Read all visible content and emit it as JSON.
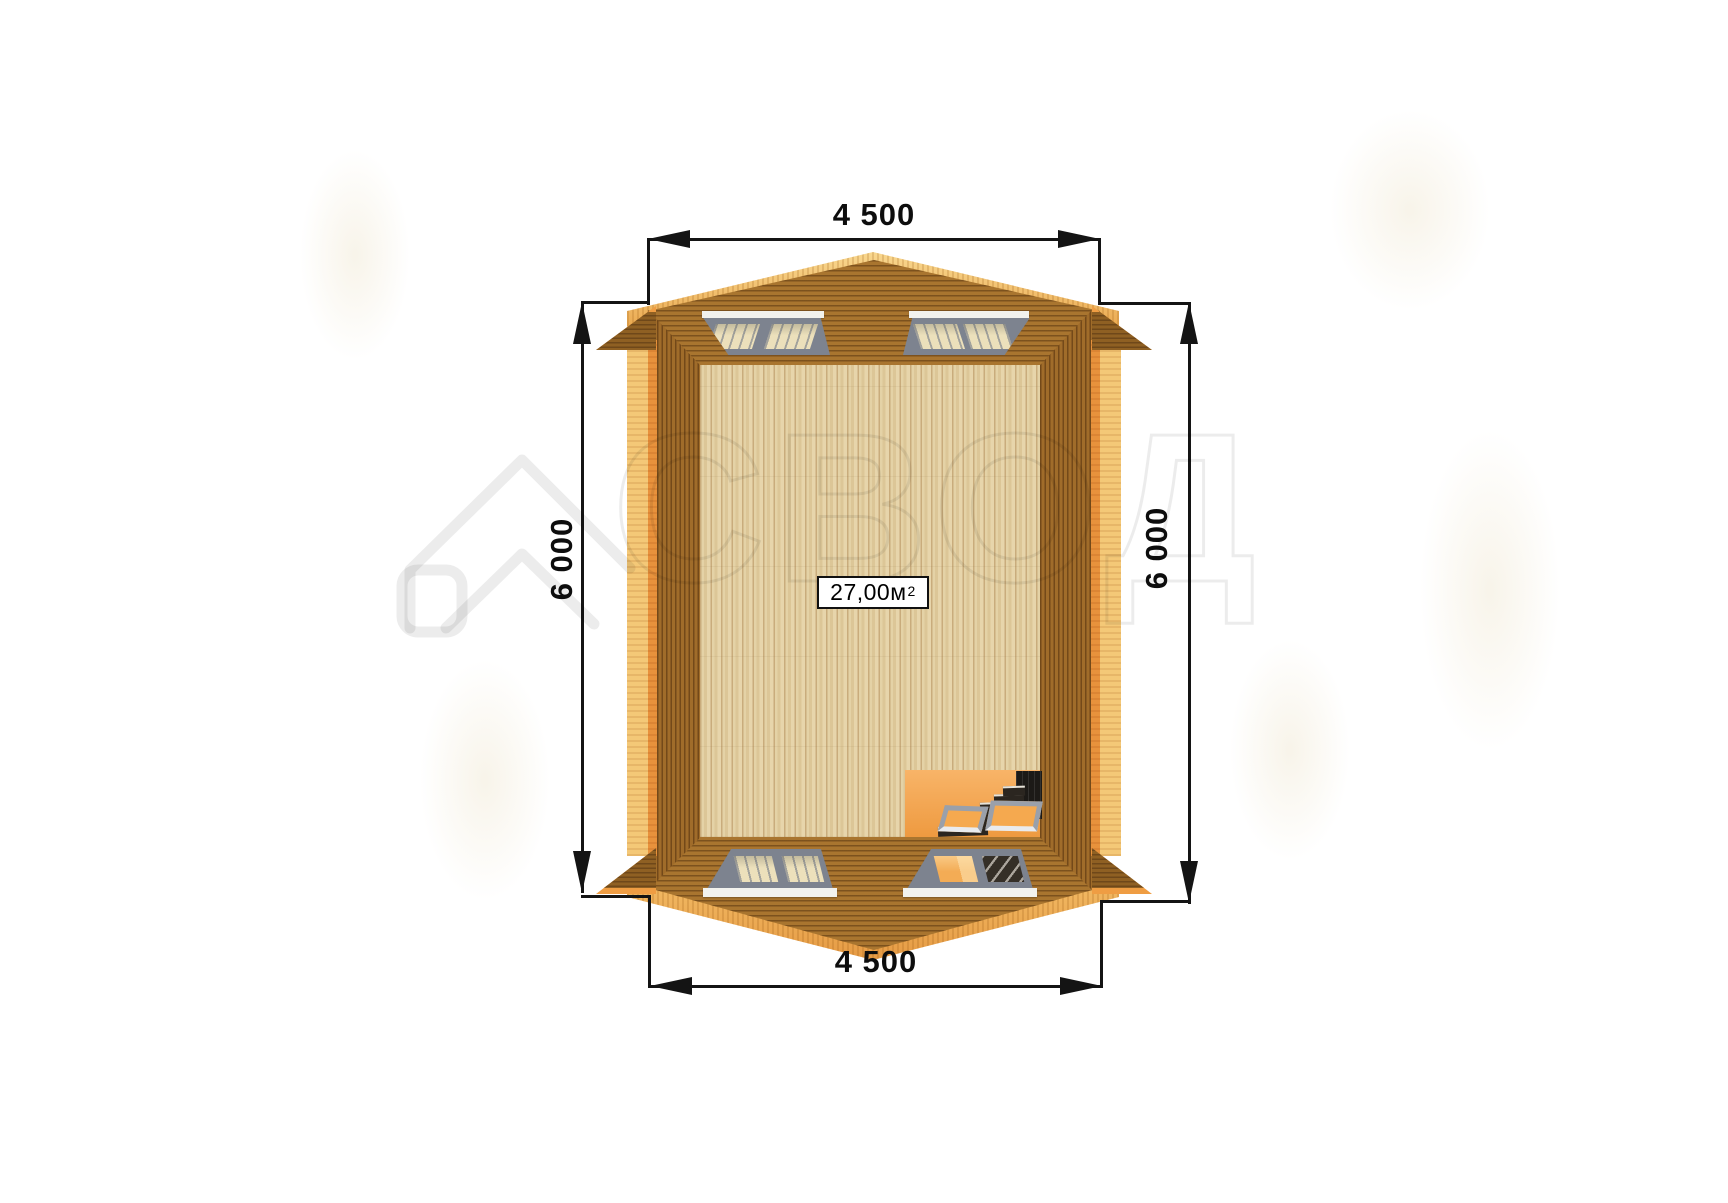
{
  "watermark": {
    "brand_text": "СВОД",
    "logo": "house-roof-outline"
  },
  "dimensions": {
    "top_width": "4 500",
    "bottom_width": "4 500",
    "left_height": "6 000",
    "right_height": "6 000"
  },
  "plan": {
    "area_value": "27,00м",
    "area_superscript": "2",
    "features": {
      "skylight_windows": 4,
      "staircase": "bottom-right opening with steps to lower floor"
    }
  },
  "colors": {
    "roof_brown": "#a9752f",
    "roof_line_brown": "#6f481a",
    "floor_tan": "#dfc99c",
    "ridge_yellow": "#f3c06a",
    "accent_orange": "#ec9a43",
    "window_frame_gray": "#7d838f",
    "dimension_black": "#141414",
    "background": "#ffffff"
  }
}
